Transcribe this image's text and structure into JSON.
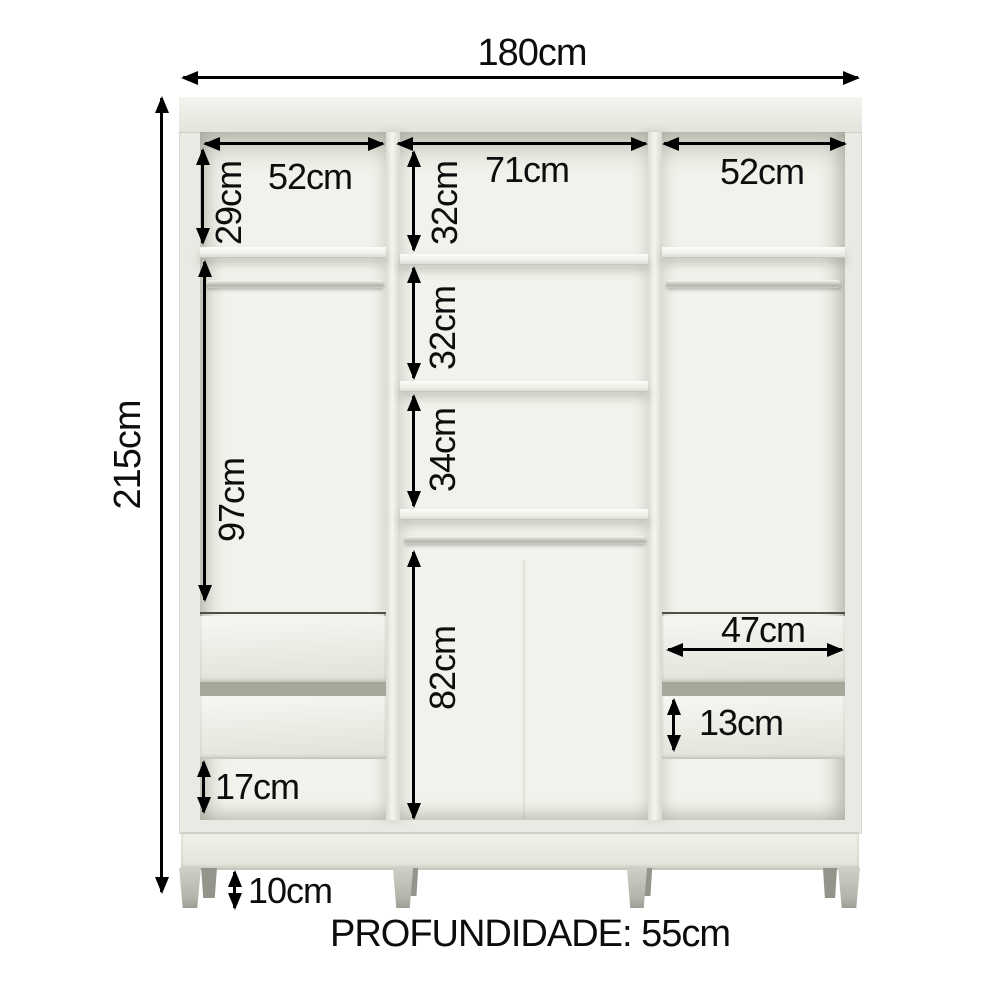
{
  "diagram": {
    "type": "furniture-dimension-diagram",
    "product": "3-door wardrobe internal layout",
    "footer": "PROFUNDIDADE: 55cm",
    "dims": {
      "total_width": "180cm",
      "total_height": "215cm",
      "left_column_width": "52cm",
      "middle_column_width": "71cm",
      "right_column_width": "52cm",
      "left_top_section_height": "29cm",
      "middle_section_1_height": "32cm",
      "middle_section_2_height": "32cm",
      "middle_section_3_height": "34cm",
      "left_hanging_section_height": "97cm",
      "middle_bottom_section_height": "82cm",
      "drawer_width": "47cm",
      "drawer_front_height": "13cm",
      "left_bottom_gap_height": "17cm",
      "feet_height": "10cm"
    },
    "colors": {
      "background": "#ffffff",
      "dimension_lines": "#000000",
      "carcass": "#eaeae4",
      "interior": "#f2f2ec",
      "drawer_gap": "#a7a79c",
      "feet": "#b4b4aa"
    }
  }
}
